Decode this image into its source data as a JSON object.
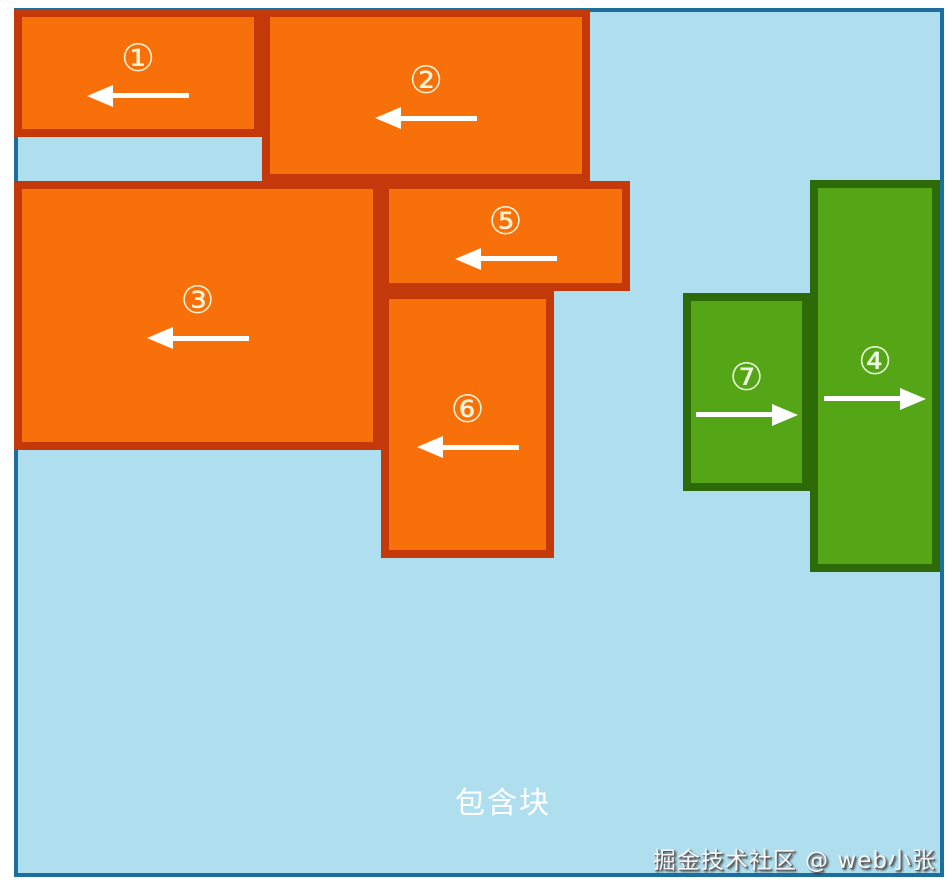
{
  "diagram": {
    "containing_block_label": "包含块",
    "watermark": "掘金技术社区 @ web小张"
  },
  "colors": {
    "page_background": "#ffffff",
    "containing_block_fill": "#afdeef",
    "containing_block_border": "#1c6f9c",
    "float_left_box_fill": "#f8700a",
    "float_left_box_border": "#c4390a",
    "float_right_box_fill": "#54a616",
    "float_right_box_border": "#2c6b07",
    "arrow": "#ffffff",
    "number_label_orange": "#fdf3d7",
    "number_label_green": "#eef9e0"
  },
  "boxes": [
    {
      "number": 1,
      "label": "①",
      "float": "left",
      "color_scheme": "orange"
    },
    {
      "number": 2,
      "label": "②",
      "float": "left",
      "color_scheme": "orange"
    },
    {
      "number": 3,
      "label": "③",
      "float": "left",
      "color_scheme": "orange"
    },
    {
      "number": 4,
      "label": "④",
      "float": "right",
      "color_scheme": "green"
    },
    {
      "number": 5,
      "label": "⑤",
      "float": "left",
      "color_scheme": "orange"
    },
    {
      "number": 6,
      "label": "⑥",
      "float": "left",
      "color_scheme": "orange"
    },
    {
      "number": 7,
      "label": "⑦",
      "float": "right",
      "color_scheme": "green"
    }
  ]
}
